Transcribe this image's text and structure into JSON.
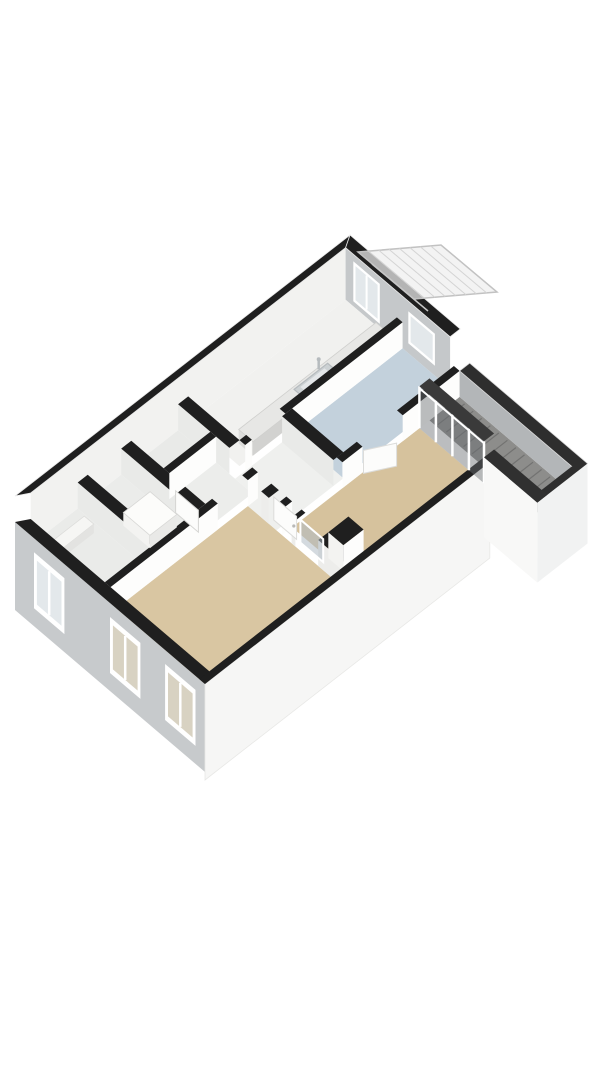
{
  "scene": {
    "label": "3D isometric floor plan of an apartment",
    "background": "#ffffff"
  },
  "palette": {
    "background": "#ffffff",
    "wall_cut": "#1f1f1f",
    "parapet_cut": "#2e2e2e",
    "wall_lit": "#f2f2f0",
    "wall_gray": "#c5c8ca",
    "wall_white": "#fdfdfc",
    "wall_b_face": "#e9eae8",
    "ext_sw_facade": "#c7cacc",
    "ext_se_facade": "#f6f6f5",
    "frame": "#ffffff",
    "glass": "#e3e8eb",
    "glass_tan": "#d8d2c2",
    "glass_dark": "rgba(104,109,112,0.45)",
    "wood": "#8d8d8b",
    "wood_grain": "rgba(58,58,60,0.32)",
    "awning_fill": "rgba(238,238,238,0.72)",
    "awning_frame": "#c2c2c2",
    "counter_top": "#e7e7e5",
    "counter_front": "#d2d2d0",
    "sink_rim": "#b6bbbe",
    "sink_basin": "#e4e7e9",
    "door_leaf": "#fcfcfb",
    "floor_tan": "#d6c29d",
    "floor_blue": "#c3d1dc",
    "floor_light": "#f0f0ee"
  },
  "rooms": [
    {
      "name": "living-room",
      "floor_color": "#d6c29d"
    },
    {
      "name": "bedroom",
      "floor_color": "#d9c6a2"
    },
    {
      "name": "bathroom",
      "floor_color": "#c3d1dc"
    },
    {
      "name": "kitchen",
      "floor_color": "#f1f1ef"
    },
    {
      "name": "hallway",
      "floor_color": "#eff0ee"
    },
    {
      "name": "storage-west",
      "floor_color": "#eaebe9"
    },
    {
      "name": "storage-mid",
      "floor_color": "#ebecea"
    },
    {
      "name": "closet-1",
      "floor_color": "#e9eae8"
    },
    {
      "name": "closet-2",
      "floor_color": "#ecedeb"
    }
  ],
  "balcony": {
    "name": "balcony-loggia",
    "floor_color": "#8d8d8b"
  },
  "fixtures": [
    "kitchen-counter",
    "kitchen-sink",
    "kitchen-faucet",
    "entrance-canopy",
    "balcony-glass-wall",
    "bedroom-door",
    "bathroom-door",
    "storage-door-leaf"
  ],
  "windows": {
    "southwest_facade": 3,
    "northeast_facade": 2,
    "balcony_glass_panels": 4
  }
}
